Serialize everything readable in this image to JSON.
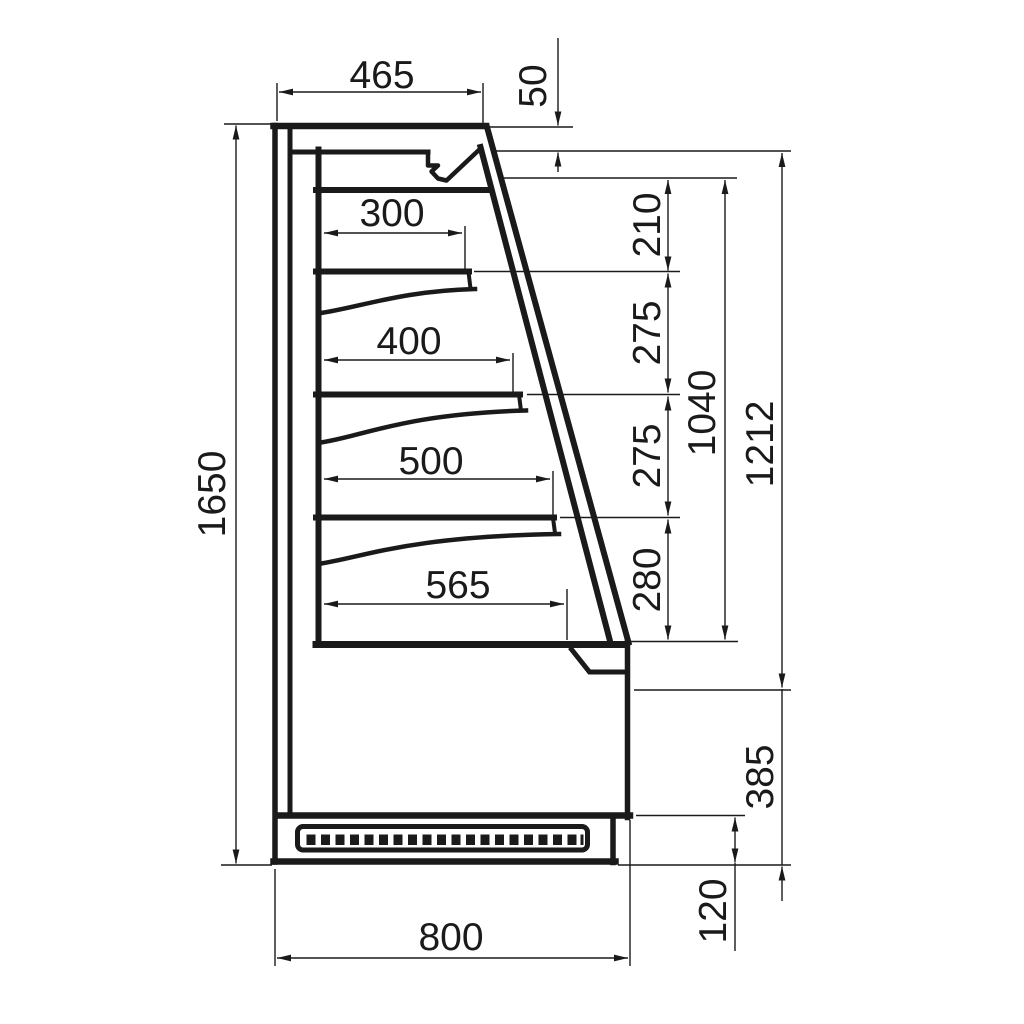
{
  "figure": {
    "kind": "technical-line-drawing",
    "subject": "display-cabinet-side-cross-section",
    "line_color": "#1a1a1a",
    "background_color": "#ffffff"
  },
  "dimensions": {
    "top_depth": "465",
    "canopy_drop": "50",
    "shelf_depths": [
      "300",
      "400",
      "500",
      "565"
    ],
    "shelf_spacings": [
      "210",
      "275",
      "275",
      "280"
    ],
    "interior_opening_height": "1040",
    "front_opening_height": "1212",
    "lower_front_height": "385",
    "plinth_height": "120",
    "overall_height": "1650",
    "overall_depth": "800"
  }
}
